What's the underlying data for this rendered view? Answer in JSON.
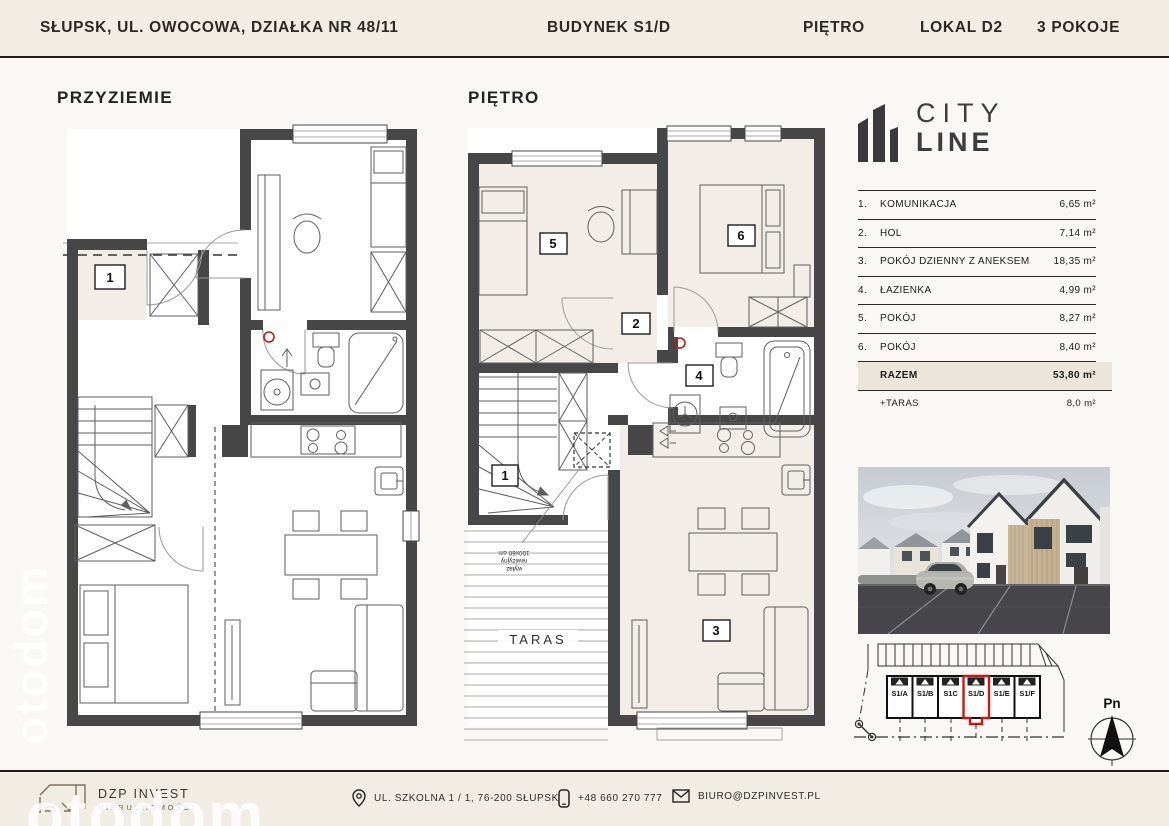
{
  "header": {
    "address": "SŁUPSK, UL. OWOCOWA, DZIAŁKA NR 48/11",
    "building": "BUDYNEK S1/D",
    "floor": "PIĘTRO",
    "unit": "LOKAL D2",
    "rooms": "3 POKOJE"
  },
  "plans": {
    "left": {
      "title": "PRZYZIEMIE"
    },
    "right": {
      "title": "PIĘTRO",
      "taras_label": "TARAS",
      "hatch_note_lines": [
        "wyłaz",
        "rewizyjny",
        "100x60 cm"
      ]
    },
    "room_labels": [
      "1",
      "2",
      "3",
      "4",
      "5",
      "6"
    ]
  },
  "brand": {
    "icon": "city-buildings-icon",
    "name_top": "CITY",
    "name_bottom": "LINE"
  },
  "area_table": {
    "rows": [
      {
        "no": "1.",
        "name": "KOMUNIKACJA",
        "value": "6,65",
        "unit": "m²"
      },
      {
        "no": "2.",
        "name": "HOL",
        "value": "7,14",
        "unit": "m²"
      },
      {
        "no": "3.",
        "name": "POKÓJ DZIENNY Z ANEKSEM",
        "value": "18,35",
        "unit": "m²"
      },
      {
        "no": "4.",
        "name": "ŁAZIENKA",
        "value": "4,99",
        "unit": "m²"
      },
      {
        "no": "5.",
        "name": "POKÓJ",
        "value": "8,27",
        "unit": "m²"
      },
      {
        "no": "6.",
        "name": "POKÓJ",
        "value": "8,40",
        "unit": "m²"
      }
    ],
    "total": {
      "label": "RAZEM",
      "value": "53,80",
      "unit": "m²"
    },
    "extra": {
      "label": "+TARAS",
      "value": "8,0",
      "unit": "m²"
    }
  },
  "siteplan": {
    "units": [
      "S1/A",
      "S1/B",
      "S1C",
      "S1/D",
      "S1/E",
      "S1/F"
    ],
    "highlighted_unit": "S1/D",
    "compass_label": "Pn",
    "highlight_color": "#C51A1A"
  },
  "footer": {
    "company": "DZP INVEST",
    "company_sub": "NIERUCHOMOŚCI",
    "address": "UL. SZKOLNA 1 / 1, 76-200 SŁUPSK",
    "phone": "+48 660 270 777",
    "email": "BIURO@DZPINVEST.PL",
    "icons": {
      "address": "location-pin-icon",
      "phone": "phone-icon",
      "email": "envelope-icon"
    }
  },
  "watermark": {
    "text": "otodom"
  },
  "colors": {
    "background": "#FAF8F4",
    "band": "#F2EDE4",
    "ink": "#262626",
    "wall": "#474747",
    "accent_red": "#C51A1A",
    "room_fill": "#F2EEE7",
    "total_row_bg": "#EBE5DB"
  }
}
